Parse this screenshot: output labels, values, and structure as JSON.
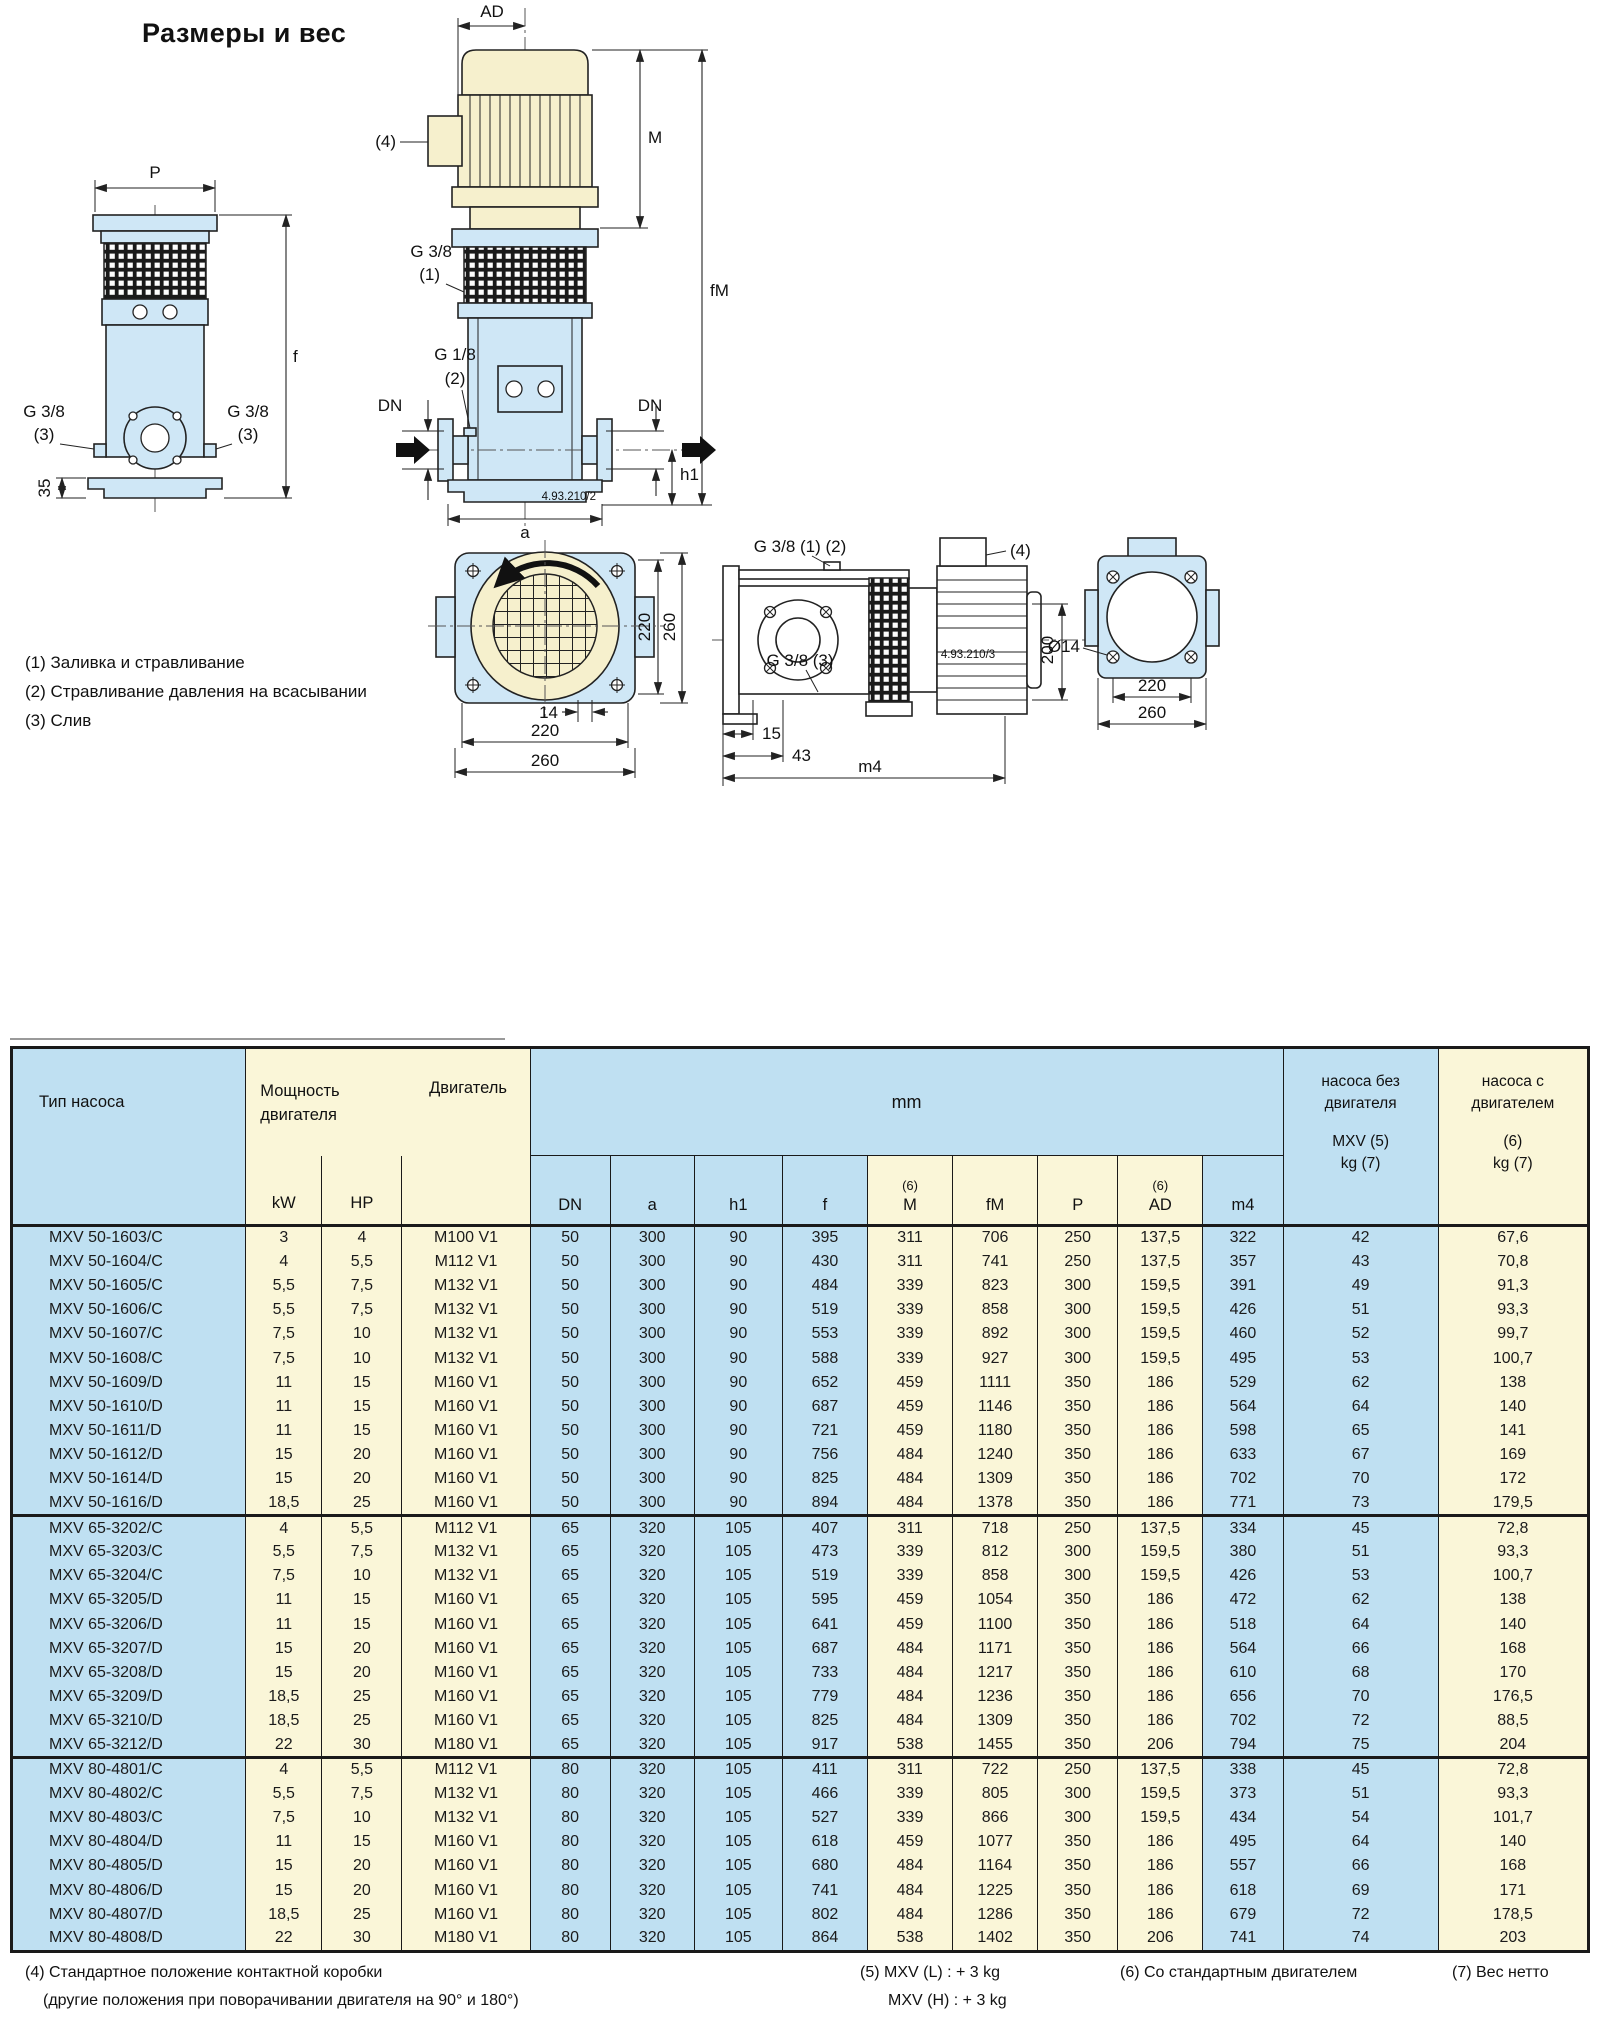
{
  "page": {
    "title": "Размеры и вес"
  },
  "legend": {
    "l1": "(1) Заливка и стравливание",
    "l2": "(2) Стравливание давления на всасывании",
    "l3": "(3) Слив"
  },
  "drawings": {
    "front": {
      "p": "P",
      "f": "f",
      "d35": "35",
      "g38": "G 3/8",
      "n3": "(3)"
    },
    "middle": {
      "ad": "AD",
      "n4": "(4)",
      "m": "M",
      "fm": "fM",
      "g38": "G 3/8",
      "n1": "(1)",
      "g18": "G 1/8",
      "n2": "(2)",
      "dn": "DN",
      "h1": "h1",
      "a": "a",
      "code": "4.93.210/2"
    },
    "top": {
      "d220": "220",
      "d260": "260",
      "d14": "14"
    },
    "side": {
      "g38_12": "G 3/8 (1) (2)",
      "n4": "(4)",
      "g38_3": "G 3/8 (3)",
      "code": "4.93.210/3",
      "d200": "200",
      "d15": "15",
      "d43": "43",
      "m4": "m4"
    },
    "flange": {
      "d14": "Ø14",
      "d220": "220",
      "d260": "260"
    }
  },
  "colors": {
    "table_blue": "#bfe0f2",
    "table_yellow": "#faf6d8",
    "part_blue": "#cfe7f6",
    "part_beige": "#f6f0cd"
  },
  "table": {
    "headers": {
      "pump_type": "Тип насоса",
      "power_l1": "Мощность",
      "power_l2": "двигателя",
      "motor": "Двигатель",
      "mm": "mm",
      "kw": "kW",
      "hp": "HP",
      "note6": "(6)",
      "sub_dn": "DN",
      "sub_a": "a",
      "sub_h1": "h1",
      "sub_f": "f",
      "sub_m": "M",
      "sub_fm": "fM",
      "sub_p": "P",
      "sub_ad": "AD",
      "sub_m4": "m4",
      "kg_pump_l1": "насоса без",
      "kg_pump_l2": "двигателя",
      "kg_pump_l3": "MXV (5)",
      "kg_pump_l4": "kg (7)",
      "kg_motor_l1": "насоса с",
      "kg_motor_l2": "двигателем",
      "kg_motor_l3": "(6)",
      "kg_motor_l4": "kg (7)"
    },
    "blocks": [
      [
        [
          "MXV 50-1603/C",
          "3",
          "4",
          "M100 V1",
          "50",
          "300",
          "90",
          "395",
          "311",
          "706",
          "250",
          "137,5",
          "322",
          "42",
          "67,6"
        ],
        [
          "MXV 50-1604/C",
          "4",
          "5,5",
          "M112 V1",
          "50",
          "300",
          "90",
          "430",
          "311",
          "741",
          "250",
          "137,5",
          "357",
          "43",
          "70,8"
        ],
        [
          "MXV 50-1605/C",
          "5,5",
          "7,5",
          "M132 V1",
          "50",
          "300",
          "90",
          "484",
          "339",
          "823",
          "300",
          "159,5",
          "391",
          "49",
          "91,3"
        ],
        [
          "MXV 50-1606/C",
          "5,5",
          "7,5",
          "M132 V1",
          "50",
          "300",
          "90",
          "519",
          "339",
          "858",
          "300",
          "159,5",
          "426",
          "51",
          "93,3"
        ],
        [
          "MXV 50-1607/C",
          "7,5",
          "10",
          "M132 V1",
          "50",
          "300",
          "90",
          "553",
          "339",
          "892",
          "300",
          "159,5",
          "460",
          "52",
          "99,7"
        ],
        [
          "MXV 50-1608/C",
          "7,5",
          "10",
          "M132 V1",
          "50",
          "300",
          "90",
          "588",
          "339",
          "927",
          "300",
          "159,5",
          "495",
          "53",
          "100,7"
        ],
        [
          "MXV 50-1609/D",
          "11",
          "15",
          "M160 V1",
          "50",
          "300",
          "90",
          "652",
          "459",
          "1111",
          "350",
          "186",
          "529",
          "62",
          "138"
        ],
        [
          "MXV 50-1610/D",
          "11",
          "15",
          "M160 V1",
          "50",
          "300",
          "90",
          "687",
          "459",
          "1146",
          "350",
          "186",
          "564",
          "64",
          "140"
        ],
        [
          "MXV 50-1611/D",
          "11",
          "15",
          "M160 V1",
          "50",
          "300",
          "90",
          "721",
          "459",
          "1180",
          "350",
          "186",
          "598",
          "65",
          "141"
        ],
        [
          "MXV 50-1612/D",
          "15",
          "20",
          "M160 V1",
          "50",
          "300",
          "90",
          "756",
          "484",
          "1240",
          "350",
          "186",
          "633",
          "67",
          "169"
        ],
        [
          "MXV 50-1614/D",
          "15",
          "20",
          "M160 V1",
          "50",
          "300",
          "90",
          "825",
          "484",
          "1309",
          "350",
          "186",
          "702",
          "70",
          "172"
        ],
        [
          "MXV 50-1616/D",
          "18,5",
          "25",
          "M160 V1",
          "50",
          "300",
          "90",
          "894",
          "484",
          "1378",
          "350",
          "186",
          "771",
          "73",
          "179,5"
        ]
      ],
      [
        [
          "MXV 65-3202/C",
          "4",
          "5,5",
          "M112 V1",
          "65",
          "320",
          "105",
          "407",
          "311",
          "718",
          "250",
          "137,5",
          "334",
          "45",
          "72,8"
        ],
        [
          "MXV 65-3203/C",
          "5,5",
          "7,5",
          "M132 V1",
          "65",
          "320",
          "105",
          "473",
          "339",
          "812",
          "300",
          "159,5",
          "380",
          "51",
          "93,3"
        ],
        [
          "MXV 65-3204/C",
          "7,5",
          "10",
          "M132 V1",
          "65",
          "320",
          "105",
          "519",
          "339",
          "858",
          "300",
          "159,5",
          "426",
          "53",
          "100,7"
        ],
        [
          "MXV 65-3205/D",
          "11",
          "15",
          "M160 V1",
          "65",
          "320",
          "105",
          "595",
          "459",
          "1054",
          "350",
          "186",
          "472",
          "62",
          "138"
        ],
        [
          "MXV 65-3206/D",
          "11",
          "15",
          "M160 V1",
          "65",
          "320",
          "105",
          "641",
          "459",
          "1100",
          "350",
          "186",
          "518",
          "64",
          "140"
        ],
        [
          "MXV 65-3207/D",
          "15",
          "20",
          "M160 V1",
          "65",
          "320",
          "105",
          "687",
          "484",
          "1171",
          "350",
          "186",
          "564",
          "66",
          "168"
        ],
        [
          "MXV 65-3208/D",
          "15",
          "20",
          "M160 V1",
          "65",
          "320",
          "105",
          "733",
          "484",
          "1217",
          "350",
          "186",
          "610",
          "68",
          "170"
        ],
        [
          "MXV 65-3209/D",
          "18,5",
          "25",
          "M160 V1",
          "65",
          "320",
          "105",
          "779",
          "484",
          "1236",
          "350",
          "186",
          "656",
          "70",
          "176,5"
        ],
        [
          "MXV 65-3210/D",
          "18,5",
          "25",
          "M160 V1",
          "65",
          "320",
          "105",
          "825",
          "484",
          "1309",
          "350",
          "186",
          "702",
          "72",
          "88,5"
        ],
        [
          "MXV 65-3212/D",
          "22",
          "30",
          "M180 V1",
          "65",
          "320",
          "105",
          "917",
          "538",
          "1455",
          "350",
          "206",
          "794",
          "75",
          "204"
        ]
      ],
      [
        [
          "MXV 80-4801/C",
          "4",
          "5,5",
          "M112 V1",
          "80",
          "320",
          "105",
          "411",
          "311",
          "722",
          "250",
          "137,5",
          "338",
          "45",
          "72,8"
        ],
        [
          "MXV 80-4802/C",
          "5,5",
          "7,5",
          "M132 V1",
          "80",
          "320",
          "105",
          "466",
          "339",
          "805",
          "300",
          "159,5",
          "373",
          "51",
          "93,3"
        ],
        [
          "MXV 80-4803/C",
          "7,5",
          "10",
          "M132 V1",
          "80",
          "320",
          "105",
          "527",
          "339",
          "866",
          "300",
          "159,5",
          "434",
          "54",
          "101,7"
        ],
        [
          "MXV 80-4804/D",
          "11",
          "15",
          "M160 V1",
          "80",
          "320",
          "105",
          "618",
          "459",
          "1077",
          "350",
          "186",
          "495",
          "64",
          "140"
        ],
        [
          "MXV 80-4805/D",
          "15",
          "20",
          "M160 V1",
          "80",
          "320",
          "105",
          "680",
          "484",
          "1164",
          "350",
          "186",
          "557",
          "66",
          "168"
        ],
        [
          "MXV 80-4806/D",
          "15",
          "20",
          "M160 V1",
          "80",
          "320",
          "105",
          "741",
          "484",
          "1225",
          "350",
          "186",
          "618",
          "69",
          "171"
        ],
        [
          "MXV 80-4807/D",
          "18,5",
          "25",
          "M160 V1",
          "80",
          "320",
          "105",
          "802",
          "484",
          "1286",
          "350",
          "186",
          "679",
          "72",
          "178,5"
        ],
        [
          "MXV 80-4808/D",
          "22",
          "30",
          "M180 V1",
          "80",
          "320",
          "105",
          "864",
          "538",
          "1402",
          "350",
          "206",
          "741",
          "74",
          "203"
        ]
      ]
    ]
  },
  "footnotes": {
    "f4a": "(4) Стандартное положение контактной коробки",
    "f4b": "(другие положения при поворачивании двигателя на 90° и 180°)",
    "f5a": "(5) MXV (L) : + 3 kg",
    "f5b": "MXV (H) : + 3 kg",
    "f6": "(6) Со стандартным двигателем",
    "f7": "(7) Вес нетто"
  }
}
